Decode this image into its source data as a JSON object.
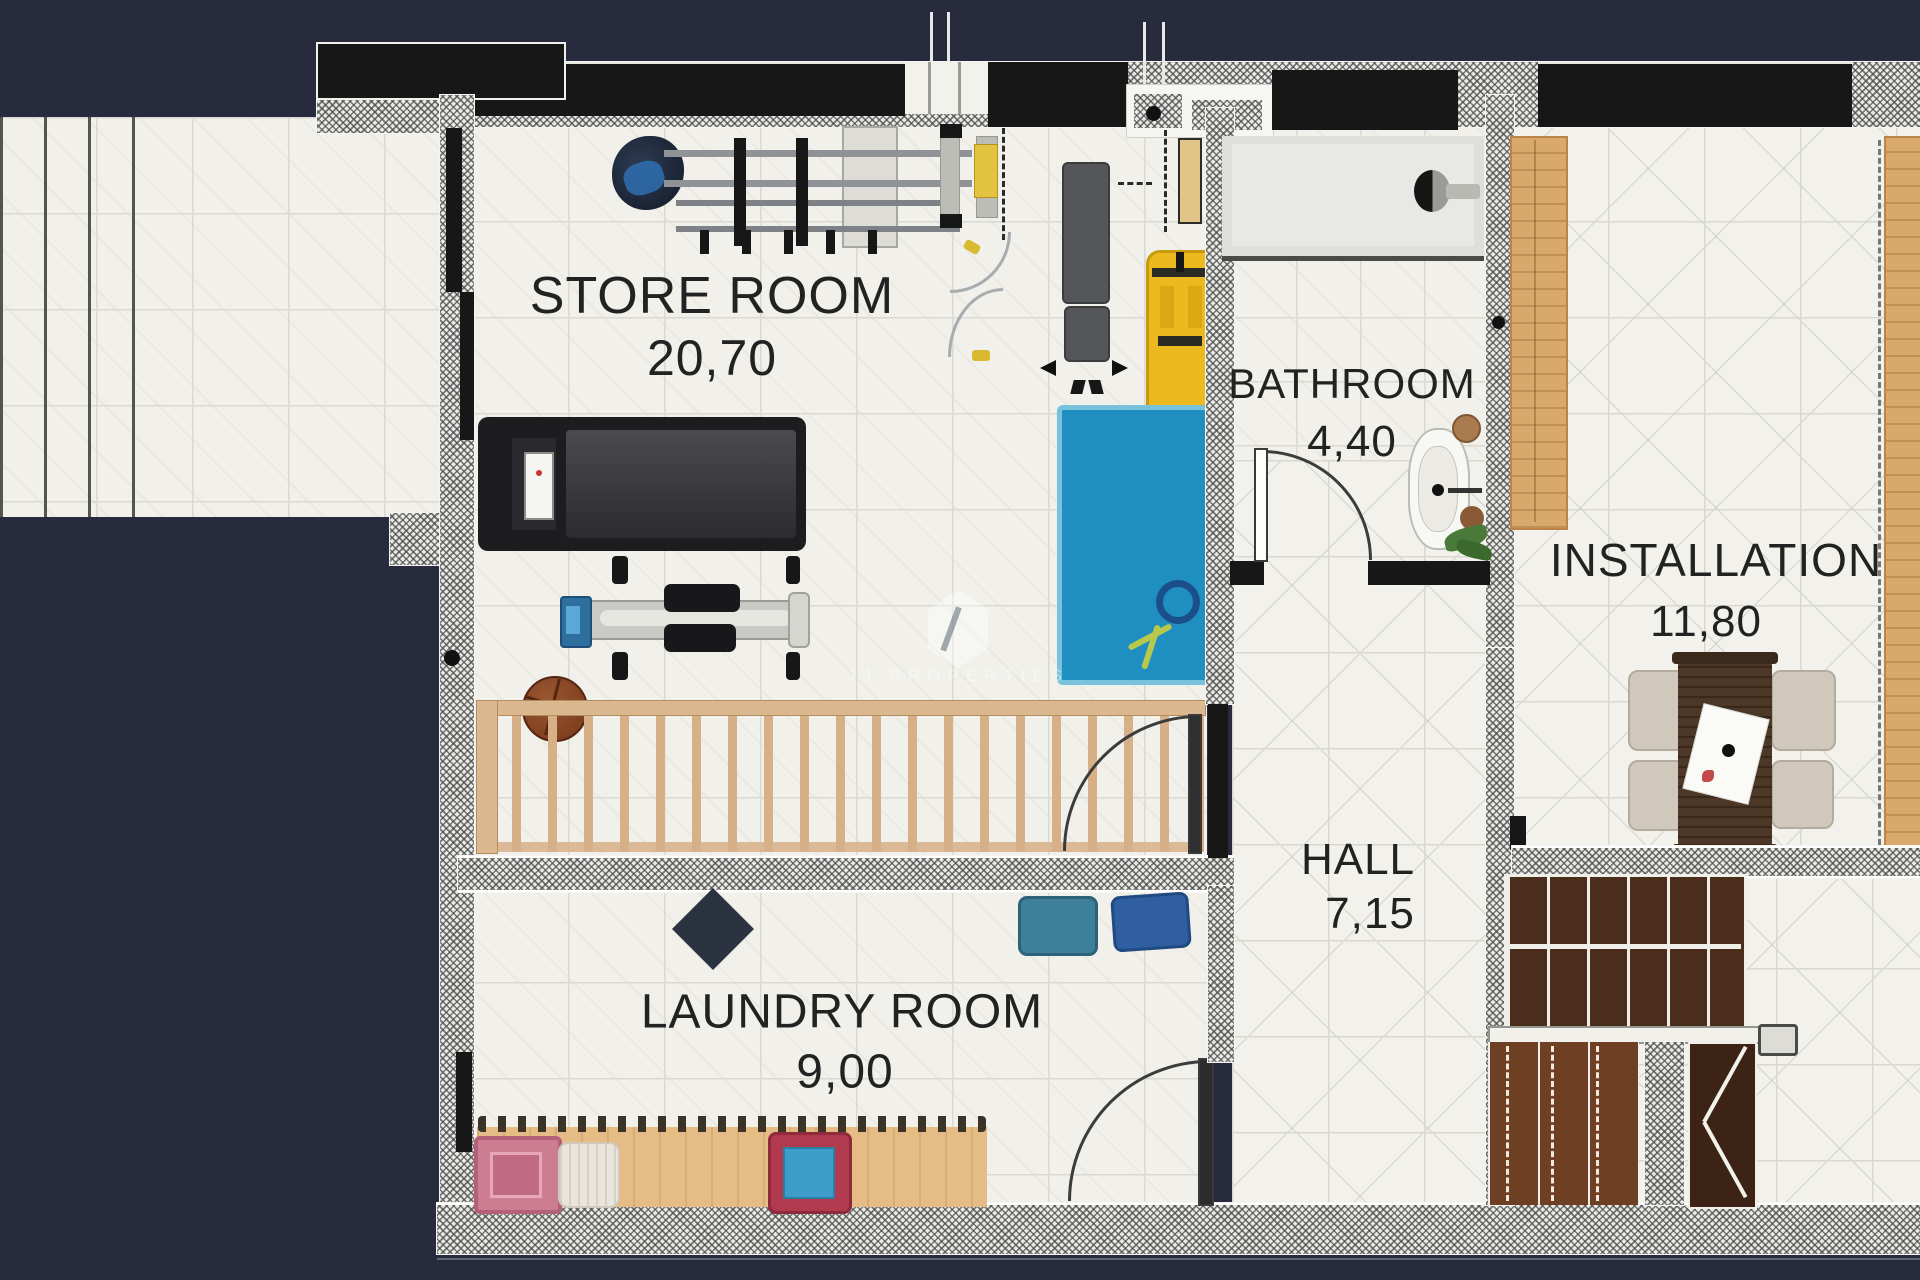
{
  "watermark": {
    "text": "JJ PROPERTIES"
  },
  "rooms": {
    "store": {
      "name": "STORE ROOM",
      "area": "20,70"
    },
    "bathroom": {
      "name": "BATHROOM",
      "area": "4,40"
    },
    "installation": {
      "name": "INSTALLATION",
      "area": "11,80"
    },
    "hall": {
      "name": "HALL",
      "area": "7,15"
    },
    "laundry": {
      "name": "LAUNDRY ROOM",
      "area": "9,00"
    }
  },
  "objects": [
    "helmet",
    "barbell-rack",
    "workout-bench",
    "weight-bench",
    "jump-rope",
    "yellow-cart",
    "gym-mat",
    "treadmill",
    "exercise-machine",
    "basketball",
    "stair-railing",
    "shower",
    "toilet",
    "plant",
    "washing-towels",
    "laundry-counter",
    "pink-box",
    "pouf",
    "laundry-basket",
    "wardrobe",
    "dining-table",
    "chairs",
    "staircase",
    "direction-arrow"
  ],
  "colors": {
    "background": "#272b3d",
    "tile": "#f1f0ea",
    "wall_black": "#171717",
    "wood": "#d9a96b",
    "counter": "#e5bc85",
    "gym_mat_blue": "#1e8fc0",
    "cart_yellow": "#ecba1e",
    "stairs_dark": "#3c2315",
    "stairs_mid": "#6e3f22",
    "pink_box": "#cd7d92",
    "basket_red": "#b23a4e",
    "basket_blue": "#3d9ec9",
    "towel_teal": "#3e7f9a",
    "towel_blue": "#2f5fa0"
  }
}
